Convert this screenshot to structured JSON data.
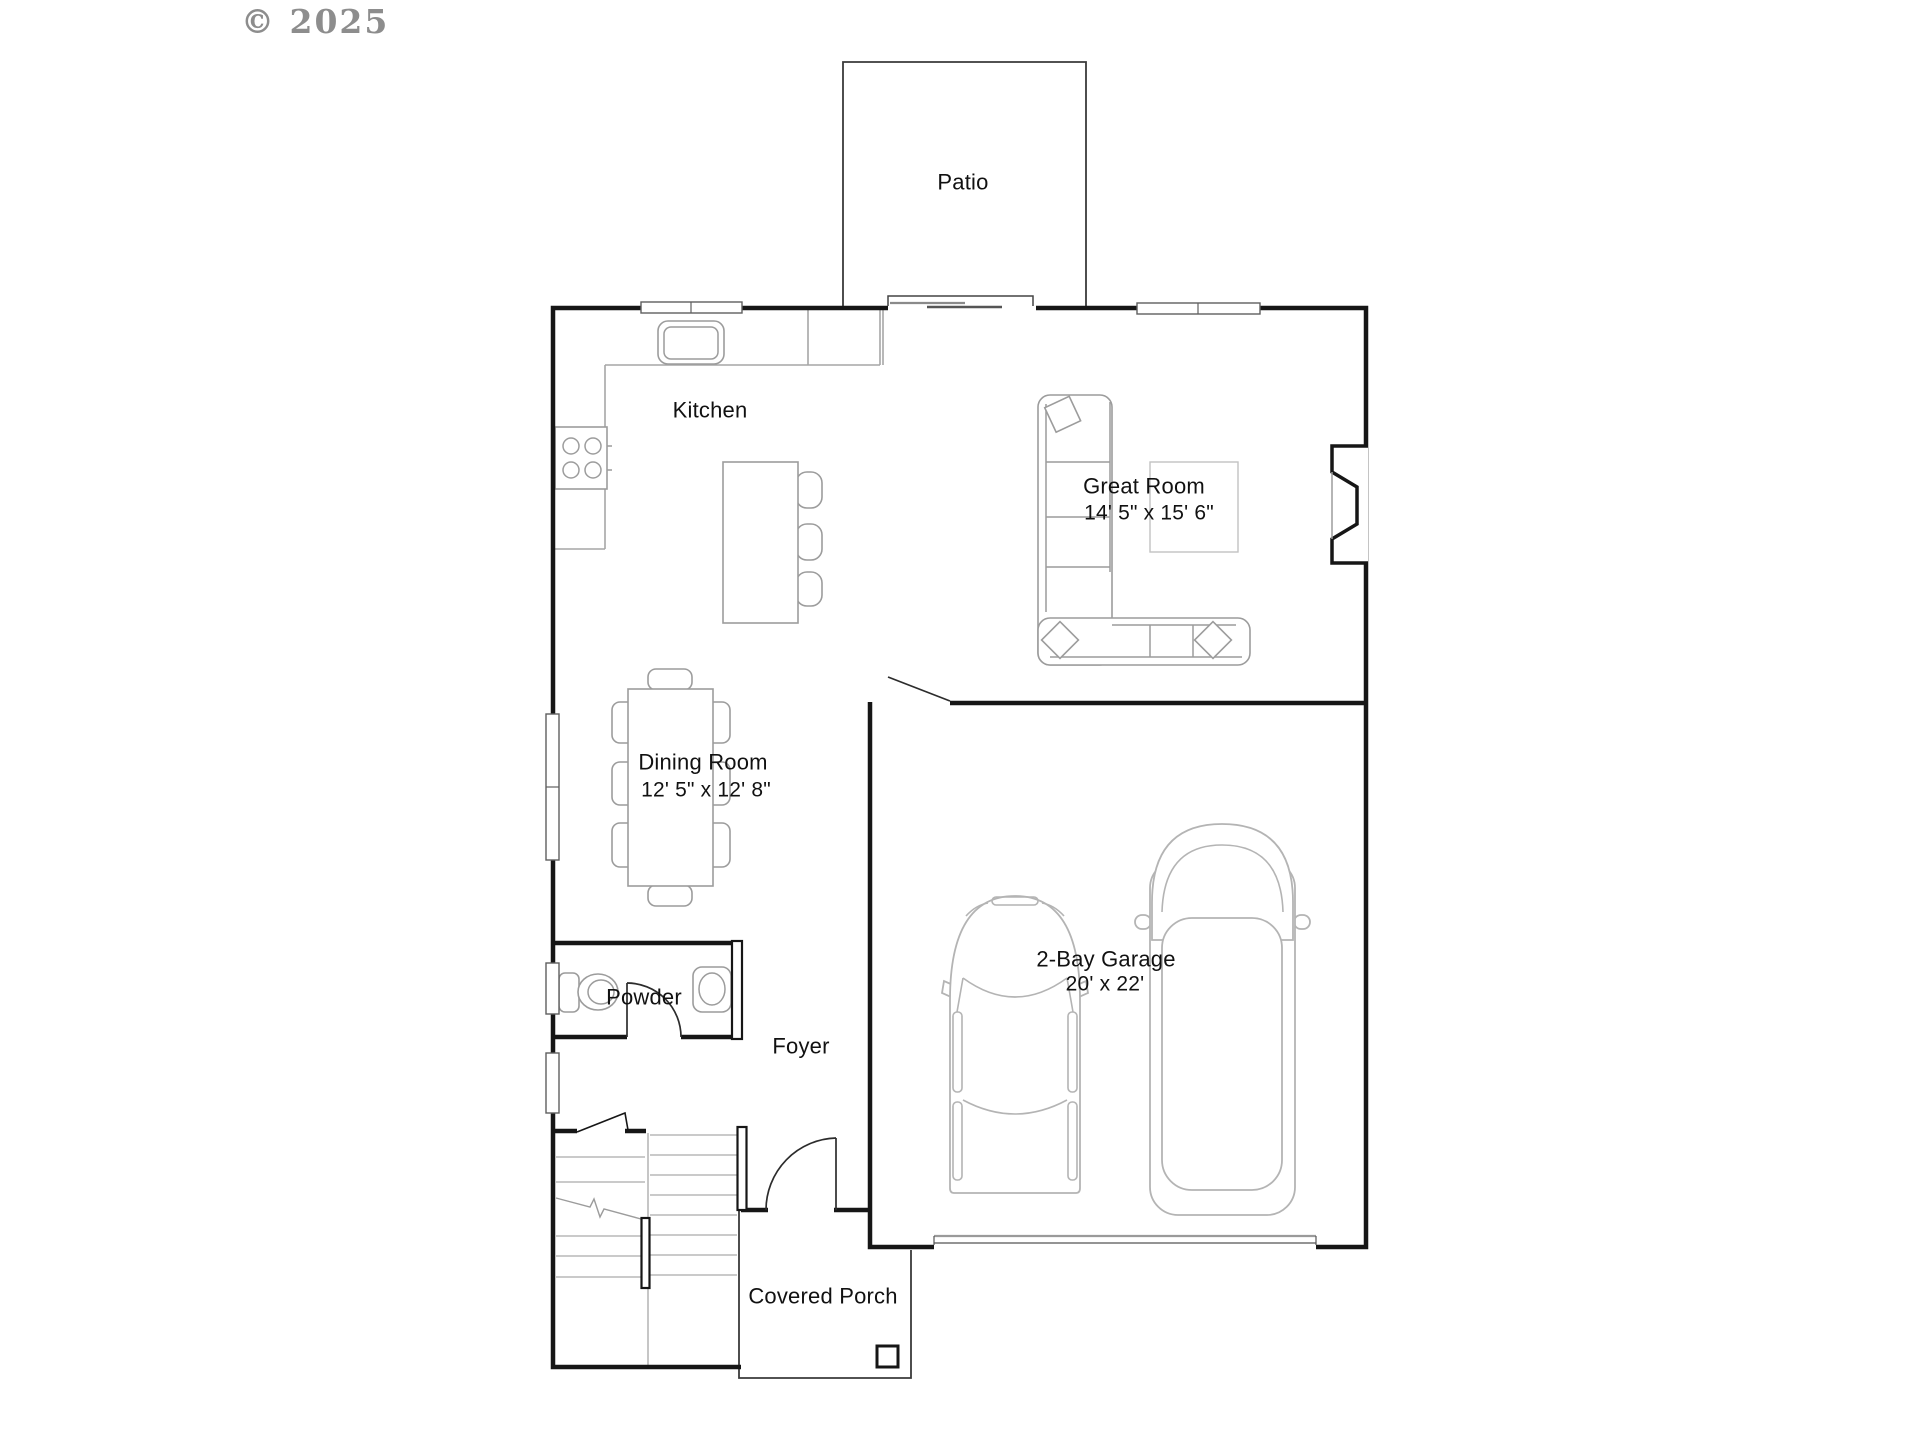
{
  "watermark": {
    "text": "© 2025"
  },
  "rooms": {
    "patio": {
      "name": "Patio"
    },
    "kitchen": {
      "name": "Kitchen"
    },
    "great_room": {
      "name": "Great Room",
      "dimensions": "14' 5\" x 15' 6\""
    },
    "dining_room": {
      "name": "Dining Room",
      "dimensions": "12' 5\" x 12' 8\""
    },
    "powder": {
      "name": "Powder"
    },
    "foyer": {
      "name": "Foyer"
    },
    "garage": {
      "name": "2-Bay Garage",
      "dimensions": "20' x 22'"
    },
    "covered_porch": {
      "name": "Covered Porch"
    }
  },
  "colors": {
    "wall": "#161616",
    "furniture": "#9c9c9c",
    "counter": "#a6a6a6",
    "stair_tread": "#b8b8b8",
    "car": "#b4b4b4",
    "text": "#111111",
    "watermark": "#8d8d8d",
    "background": "#ffffff"
  }
}
